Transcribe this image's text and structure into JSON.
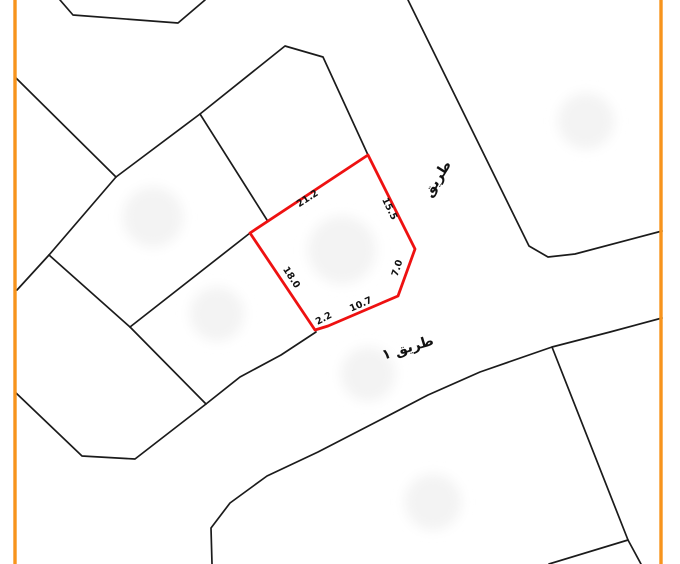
{
  "map": {
    "background_color": "#ffffff",
    "frame_color": "#f7941d",
    "boundary_color": "#1b1b1b",
    "parcel_outline_color": "#ee1111",
    "footprint_color": "#f3f3f3",
    "label_color": "#111111",
    "road_labels": [
      {
        "id": "upper-road",
        "text": "طريق"
      },
      {
        "id": "lower-road",
        "text": "طريق ١"
      }
    ],
    "parcel_dimensions": [
      {
        "edge": "northwest",
        "value": "21.2"
      },
      {
        "edge": "northeast",
        "value": "15.5"
      },
      {
        "edge": "east",
        "value": "7.0"
      },
      {
        "edge": "south",
        "value": "10.7"
      },
      {
        "edge": "south-corner",
        "value": "2.2"
      },
      {
        "edge": "southwest",
        "value": "18.0"
      }
    ]
  }
}
